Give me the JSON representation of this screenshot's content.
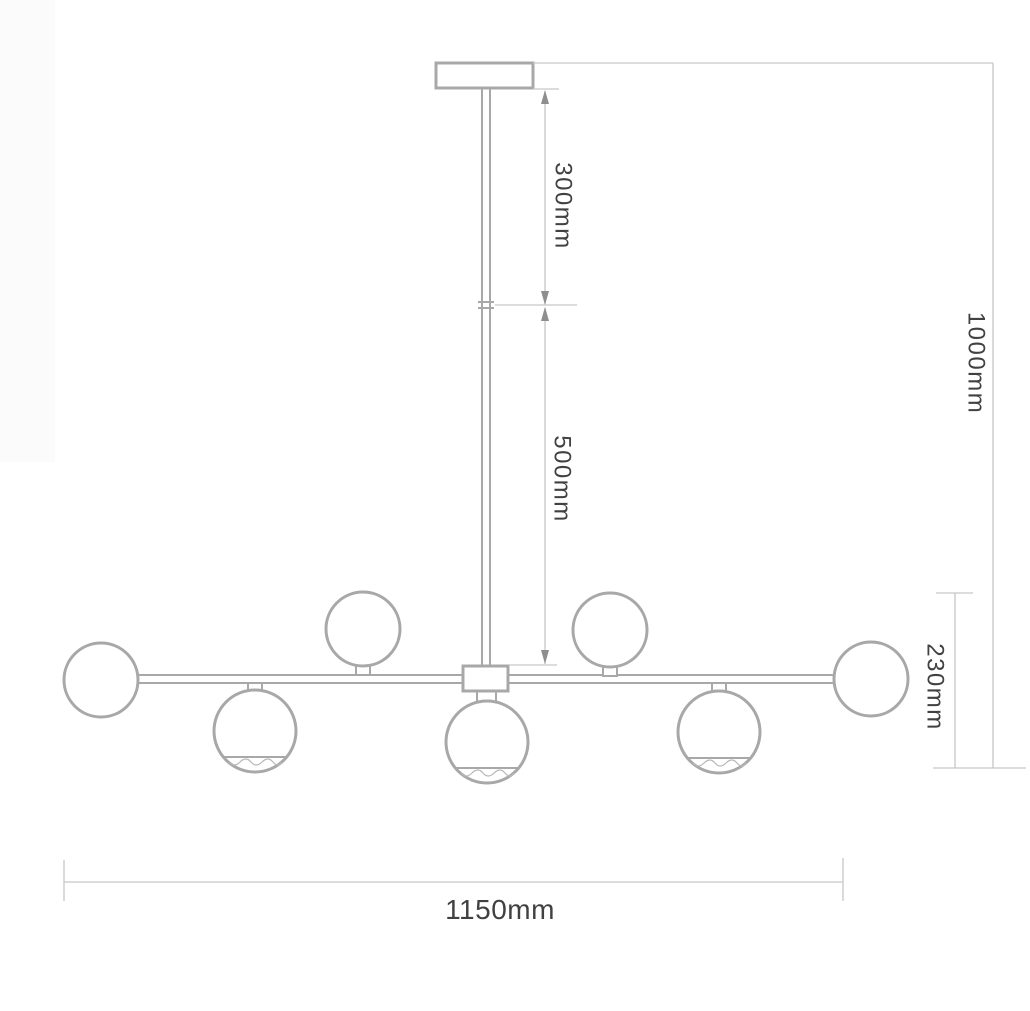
{
  "diagram": {
    "title": "chandelier-dimension-diagram",
    "labels": {
      "upper_rod_length": "300mm",
      "lower_rod_length": "500mm",
      "total_drop": "1000mm",
      "body_height": "230mm",
      "total_width": "1150mm"
    },
    "fixture": {
      "globe_count": 7,
      "globes_above_bar": 2,
      "globes_below_bar": 3,
      "globes_at_ends": 2
    },
    "colors": {
      "fixture_line": "#a8a8a8",
      "dim_line": "#c6c6c6",
      "arrow": "#8e8e8e",
      "text": "#414141",
      "hatch": "#b8b8b8",
      "background": "#ffffff",
      "margin_shade": "#fcfbfb"
    }
  }
}
